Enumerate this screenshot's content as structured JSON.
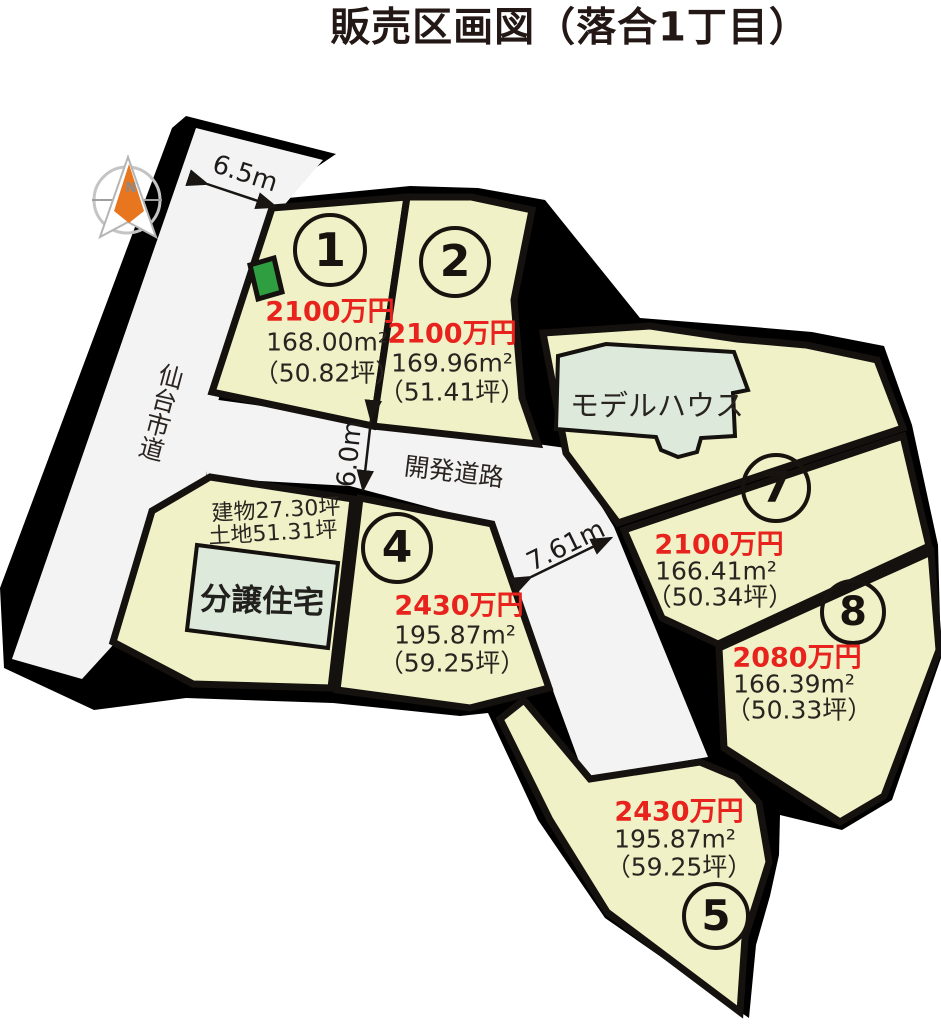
{
  "title": "販売区画図（落合1丁目）",
  "compass": {
    "north_label": "N"
  },
  "roads": {
    "city_road": "仙台市道",
    "development_road": "開発道路"
  },
  "measurements": {
    "north_road_width": "6.5m",
    "dev_road_width": "6.0m",
    "south_road_width": "7.61m"
  },
  "model_house": {
    "label": "モデルハウス"
  },
  "bunjo": {
    "label": "分譲住宅",
    "building_area": "建物27.30坪",
    "land_area": "土地51.31坪"
  },
  "lots": [
    {
      "number": "1",
      "price": "2100万円",
      "area": "168.00m²",
      "tsubo": "（50.82坪）"
    },
    {
      "number": "2",
      "price": "2100万円",
      "area": "169.96m²",
      "tsubo": "（51.41坪）"
    },
    {
      "number": "4",
      "price": "2430万円",
      "area": "195.87m²",
      "tsubo": "（59.25坪）"
    },
    {
      "number": "5",
      "price": "2430万円",
      "area": "195.87m²",
      "tsubo": "（59.25坪）"
    },
    {
      "number": "7",
      "price": "2100万円",
      "area": "166.41m²",
      "tsubo": "（50.34坪）"
    },
    {
      "number": "8",
      "price": "2080万円",
      "area": "166.39m²",
      "tsubo": "（50.33坪）"
    }
  ],
  "colors": {
    "lot_fill": "#f0f1c6",
    "road_fill": "#f3f3f3",
    "building_fill": "#dce9db",
    "price_red": "#e8231d",
    "ink": "#231815",
    "marker_green": "#2f9e41",
    "compass_orange": "#e8761f",
    "base_black": "#000000"
  }
}
